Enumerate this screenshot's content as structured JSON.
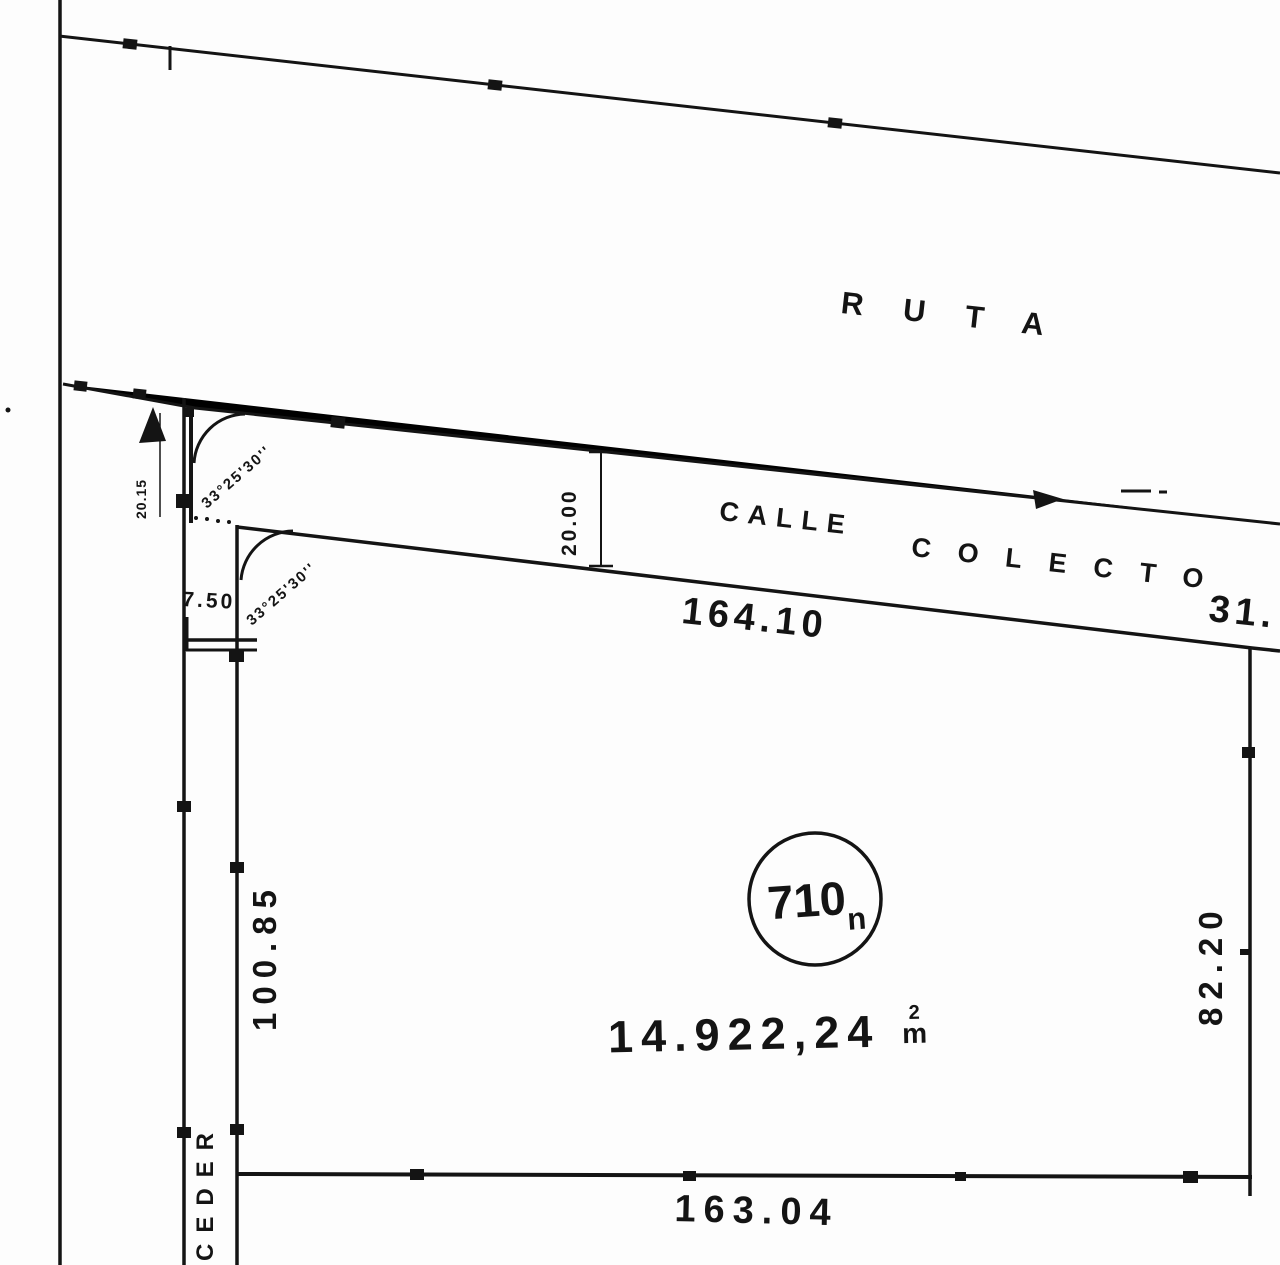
{
  "plan": {
    "route_label": "RUTA",
    "street_label_primary": "CALLE",
    "street_label_secondary": "COLECTO",
    "cede_label": "CEDER",
    "parcel": {
      "id": "710",
      "id_suffix": "n",
      "area_value": "14.922,24",
      "area_unit_exponent": "2",
      "area_unit_base": "m"
    },
    "dimensions": {
      "frontage": "164.10",
      "frontage_right_partial": "31.",
      "west_side": "100.85",
      "east_side": "82.20",
      "rear": "163.04",
      "street_width": "20.00",
      "street_width_at_corner": "20.15",
      "cede_strip_width": "7.50",
      "angle_upper": "33°25'30''",
      "angle_lower": "33°25'30''"
    },
    "ink_color": "#141414",
    "paper_color": "#fdfdfd"
  }
}
